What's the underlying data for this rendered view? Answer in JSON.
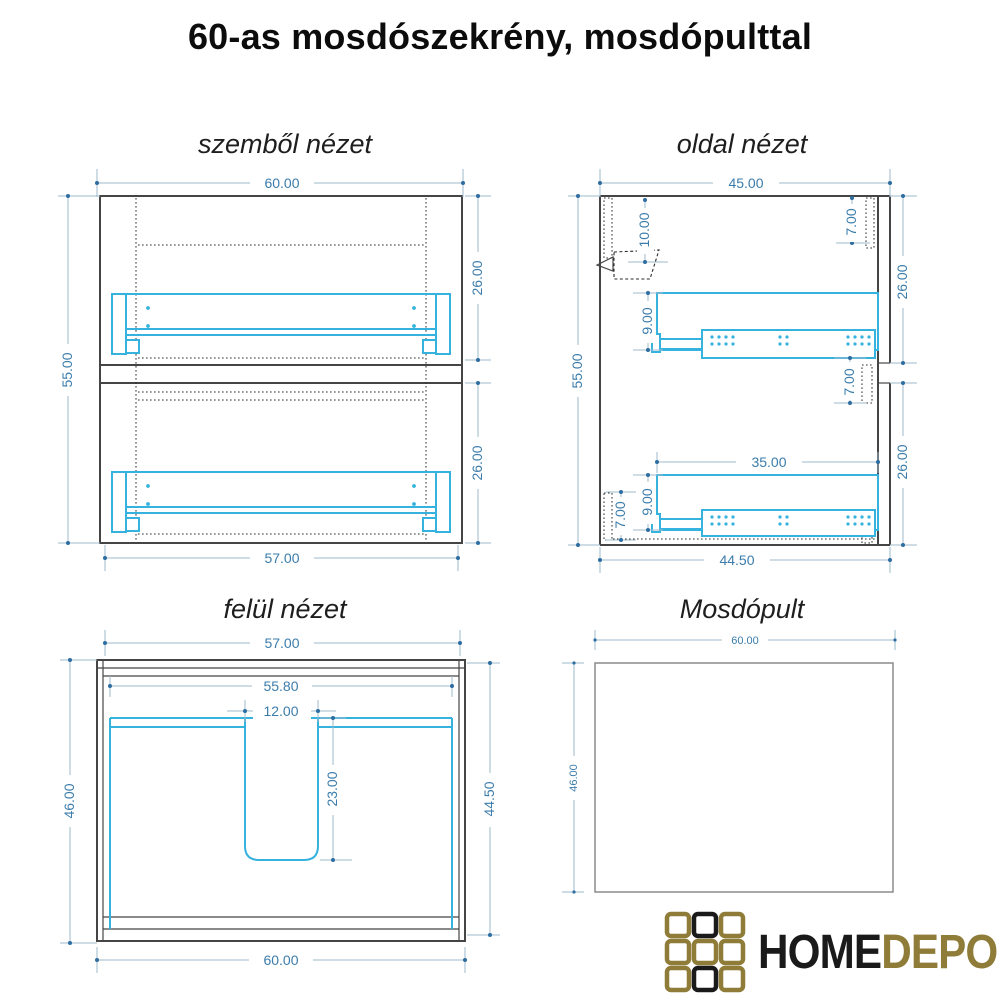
{
  "page": {
    "title": "60-as mosdószekrény, mosdópulttal"
  },
  "views": {
    "front": {
      "title": "szemből nézet",
      "dims": {
        "width_top": "60.00",
        "height_left": "55.00",
        "upper_drawer_right": "26.00",
        "lower_drawer_right": "26.00",
        "width_bottom": "57.00"
      }
    },
    "side": {
      "title": "oldal nézet",
      "dims": {
        "depth_top": "45.00",
        "height_left": "55.00",
        "hang_bracket": "10.00",
        "top_rail": "7.00",
        "upper_front_right": "26.00",
        "upper_drawer_side": "9.00",
        "mid_rail": "7.00",
        "slide_length": "35.00",
        "lower_drawer_side": "9.00",
        "back_rail": "7.00",
        "lower_front_right": "26.00",
        "depth_bottom": "44.50"
      }
    },
    "top": {
      "title": "felül nézet",
      "dims": {
        "width_top": "57.00",
        "inner_width": "55.80",
        "cutout_width": "12.00",
        "cutout_depth": "23.00",
        "depth_left": "46.00",
        "depth_right": "44.50",
        "width_bottom": "60.00"
      }
    },
    "counter": {
      "title": "Mosdópult",
      "dims": {
        "width_top": "60.00",
        "depth_left": "46.00"
      }
    }
  },
  "logo": {
    "home": "HOME",
    "depo": "DEPO"
  },
  "colors": {
    "dim_text": "#3b7cab",
    "dim_line": "#9db9ce",
    "dim_dot": "#2e6da0",
    "cabinet_ink": "#454545",
    "drawer_cyan": "#35b2dd",
    "logo_olive": "#8e7c38",
    "logo_black": "#1a1a1a"
  }
}
